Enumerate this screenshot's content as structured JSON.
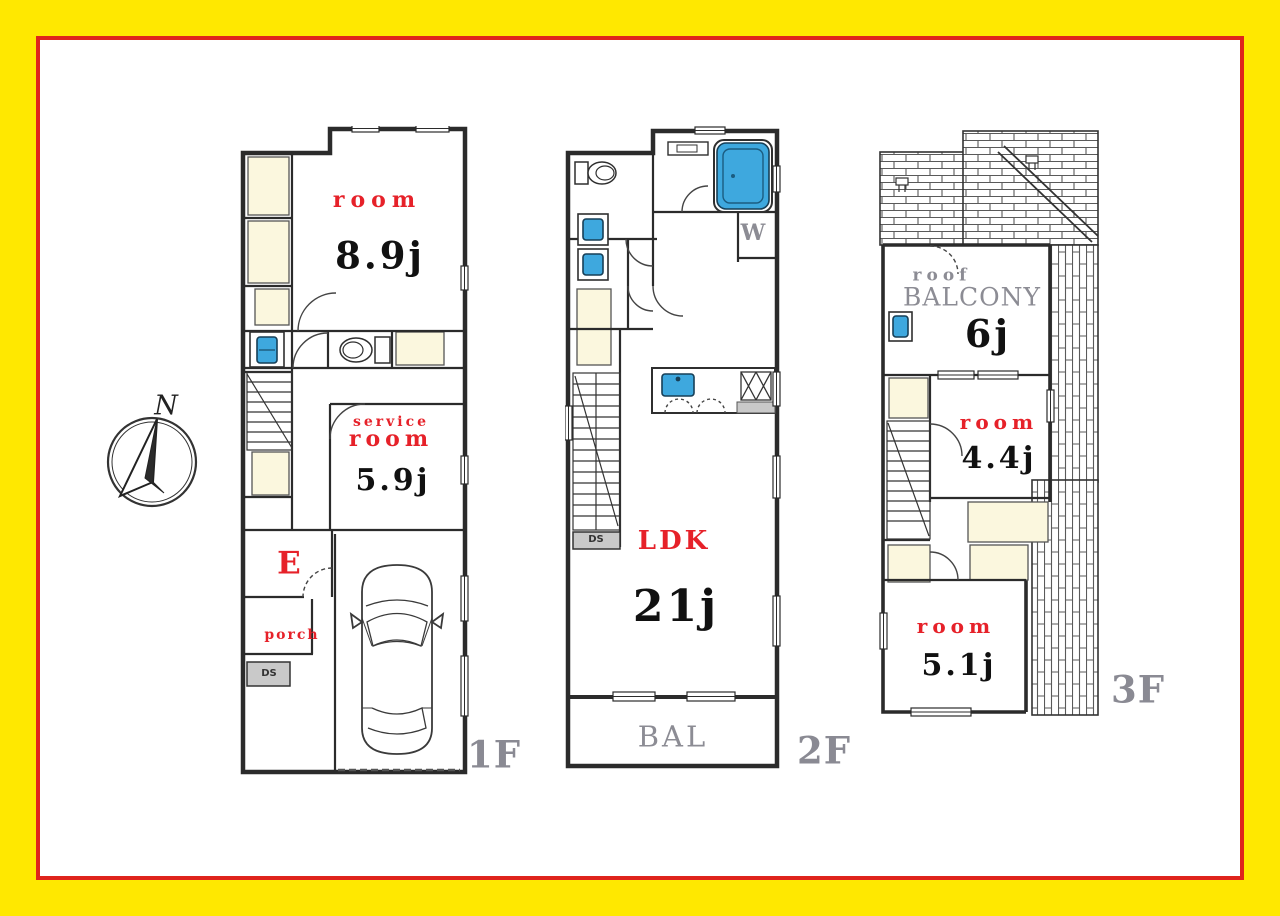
{
  "title": "3-story house floor plan",
  "compass": {
    "n": "N"
  },
  "f1": {
    "floor_label": "1F",
    "room_name": "room",
    "room_size": "8.9j",
    "service_line1": "service",
    "service_line2": "room",
    "service_size": "5.9j",
    "entrance": "E",
    "porch": "porch",
    "ds": "DS"
  },
  "f2": {
    "floor_label": "2F",
    "ldk_name": "LDK",
    "ldk_size": "21j",
    "balcony": "BAL",
    "washer": "W",
    "ds": "DS"
  },
  "f3": {
    "floor_label": "3F",
    "roof_line1": "roof",
    "roof_line2": "BALCONY",
    "roof_size": "6j",
    "room1_name": "room",
    "room1_size": "4.4j",
    "room2_name": "room",
    "room2_size": "5.1j"
  },
  "colors": {
    "frame_yellow": "#FFE800",
    "frame_red": "#DF241C",
    "wall": "#2b2b2b",
    "closet_fill": "#FBF7DE",
    "fixture_blue": "#3EA8DE",
    "label_red": "#E62129",
    "label_gray": "#8C8C94"
  }
}
